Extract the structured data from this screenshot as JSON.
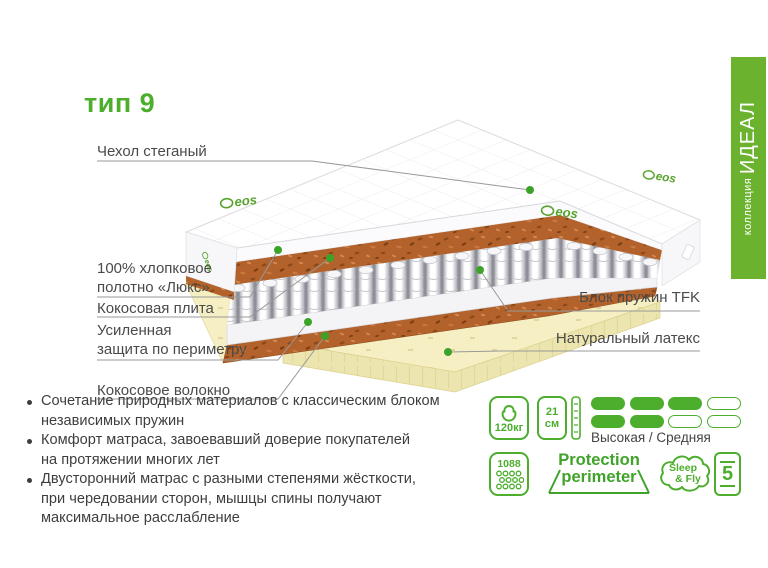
{
  "title": "тип 9",
  "banner": {
    "collection_label": "коллекция",
    "collection_name": "ИДЕАЛ"
  },
  "illustration": {
    "brand": "eos"
  },
  "labels": {
    "cover": "Чехол стеганый",
    "cotton": "100% хлопковое\nполотно «Люкс»",
    "coir_plate": "Кокосовая плита",
    "perimeter": "Усиленная\nзащита по периметру",
    "coir_fiber": "Кокосовое волокно",
    "springs": "Блок пружин TFK",
    "latex": "Натуральный латекс"
  },
  "features": [
    "Сочетание природных материалов с классическим блоком\nнезависимых пружин",
    "Комфорт матраса, завоевавший доверие покупателей\nна протяжении многих лет",
    "Двусторонний матрас с разными степенями жёсткости,\nпри чередовании сторон, мышцы спины получают\nмаксимальное расслабление"
  ],
  "specs": {
    "max_weight": "120кг",
    "height_value": "21",
    "height_unit": "см",
    "firmness": {
      "label": "Высокая / Средняя",
      "top_filled": 3,
      "bottom_filled": 2,
      "total": 4
    },
    "springs_count": "1088",
    "protection_line1": "Protection",
    "protection_line2": "perimeter",
    "brand_line1": "Sleep",
    "brand_line2": "& Fly",
    "warranty_years": "5"
  },
  "colors": {
    "accent": "#4CAE2C",
    "banner": "#6BB22F",
    "coir": "#B2622A",
    "latex": "#F5EFC3",
    "dot": "#3BA428"
  }
}
